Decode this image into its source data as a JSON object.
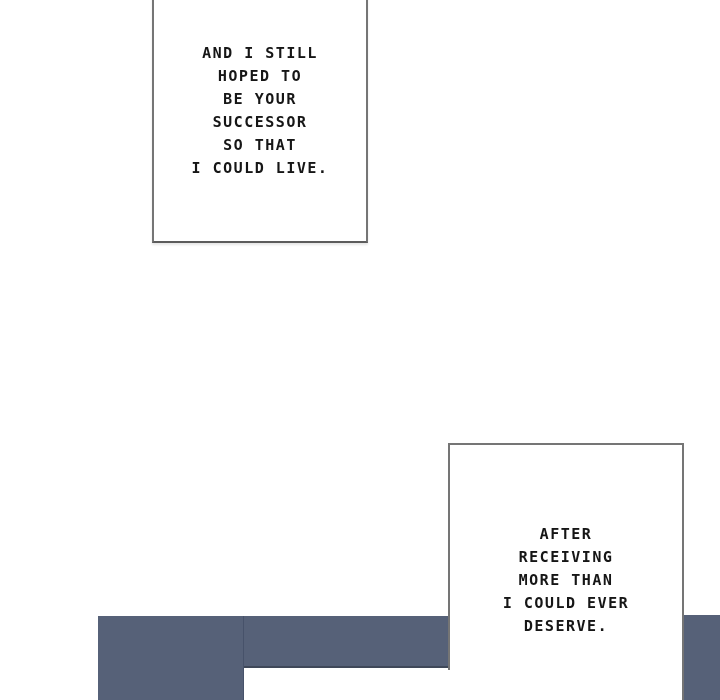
{
  "page": {
    "kind": "webtoon-comic-panel",
    "background_color": "#ffffff"
  },
  "colors": {
    "panel_dark": "#566178",
    "panel_dark_edge": "#3f4859",
    "caption_border": "#757575",
    "caption_text": "#161616"
  },
  "bubbles": [
    {
      "name": "caption-box-1",
      "lines": [
        "AND I STILL",
        "HOPED TO",
        "BE YOUR",
        "SUCCESSOR",
        "SO THAT",
        "I COULD LIVE."
      ],
      "full_text": "AND I STILL HOPED TO BE YOUR SUCCESSOR SO THAT I COULD LIVE."
    },
    {
      "name": "caption-box-2",
      "lines": [
        "AFTER",
        "RECEIVING",
        "MORE THAN",
        "I COULD EVER",
        "DESERVE."
      ],
      "full_text": "AFTER RECEIVING MORE THAN I COULD EVER DESERVE."
    }
  ]
}
